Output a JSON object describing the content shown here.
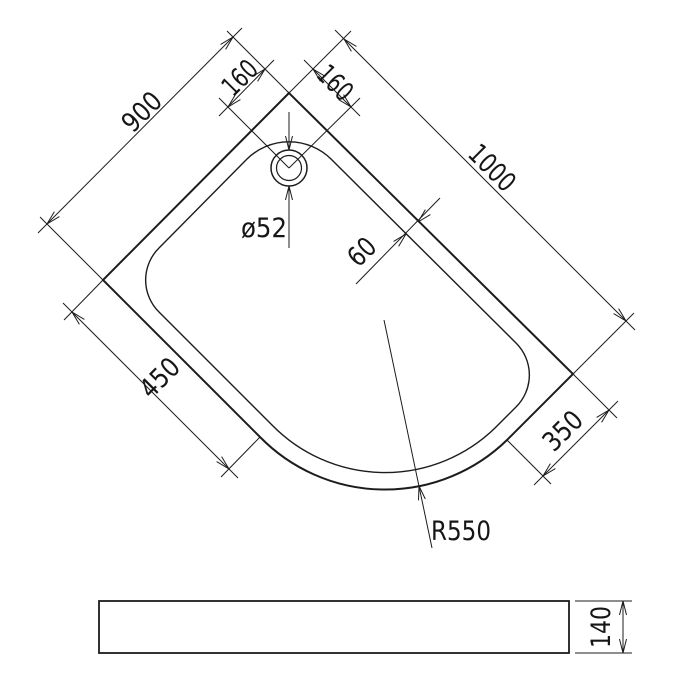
{
  "drawing": {
    "type": "technical-dimension-drawing",
    "subject": "offset quadrant shower tray",
    "colors": {
      "line": "#1c1c1c",
      "background": "#ffffff"
    },
    "plan_view": {
      "label_back_edge_left": "900",
      "label_back_edge_right": "1000",
      "label_drain_offset_left": "160",
      "label_drain_offset_right": "160",
      "label_rim_width": "60",
      "label_front_edge_left": "450",
      "label_front_edge_right": "350",
      "label_corner_radius": "R550",
      "label_drain_diameter": "ø52"
    },
    "side_view": {
      "label_height": "140"
    }
  }
}
